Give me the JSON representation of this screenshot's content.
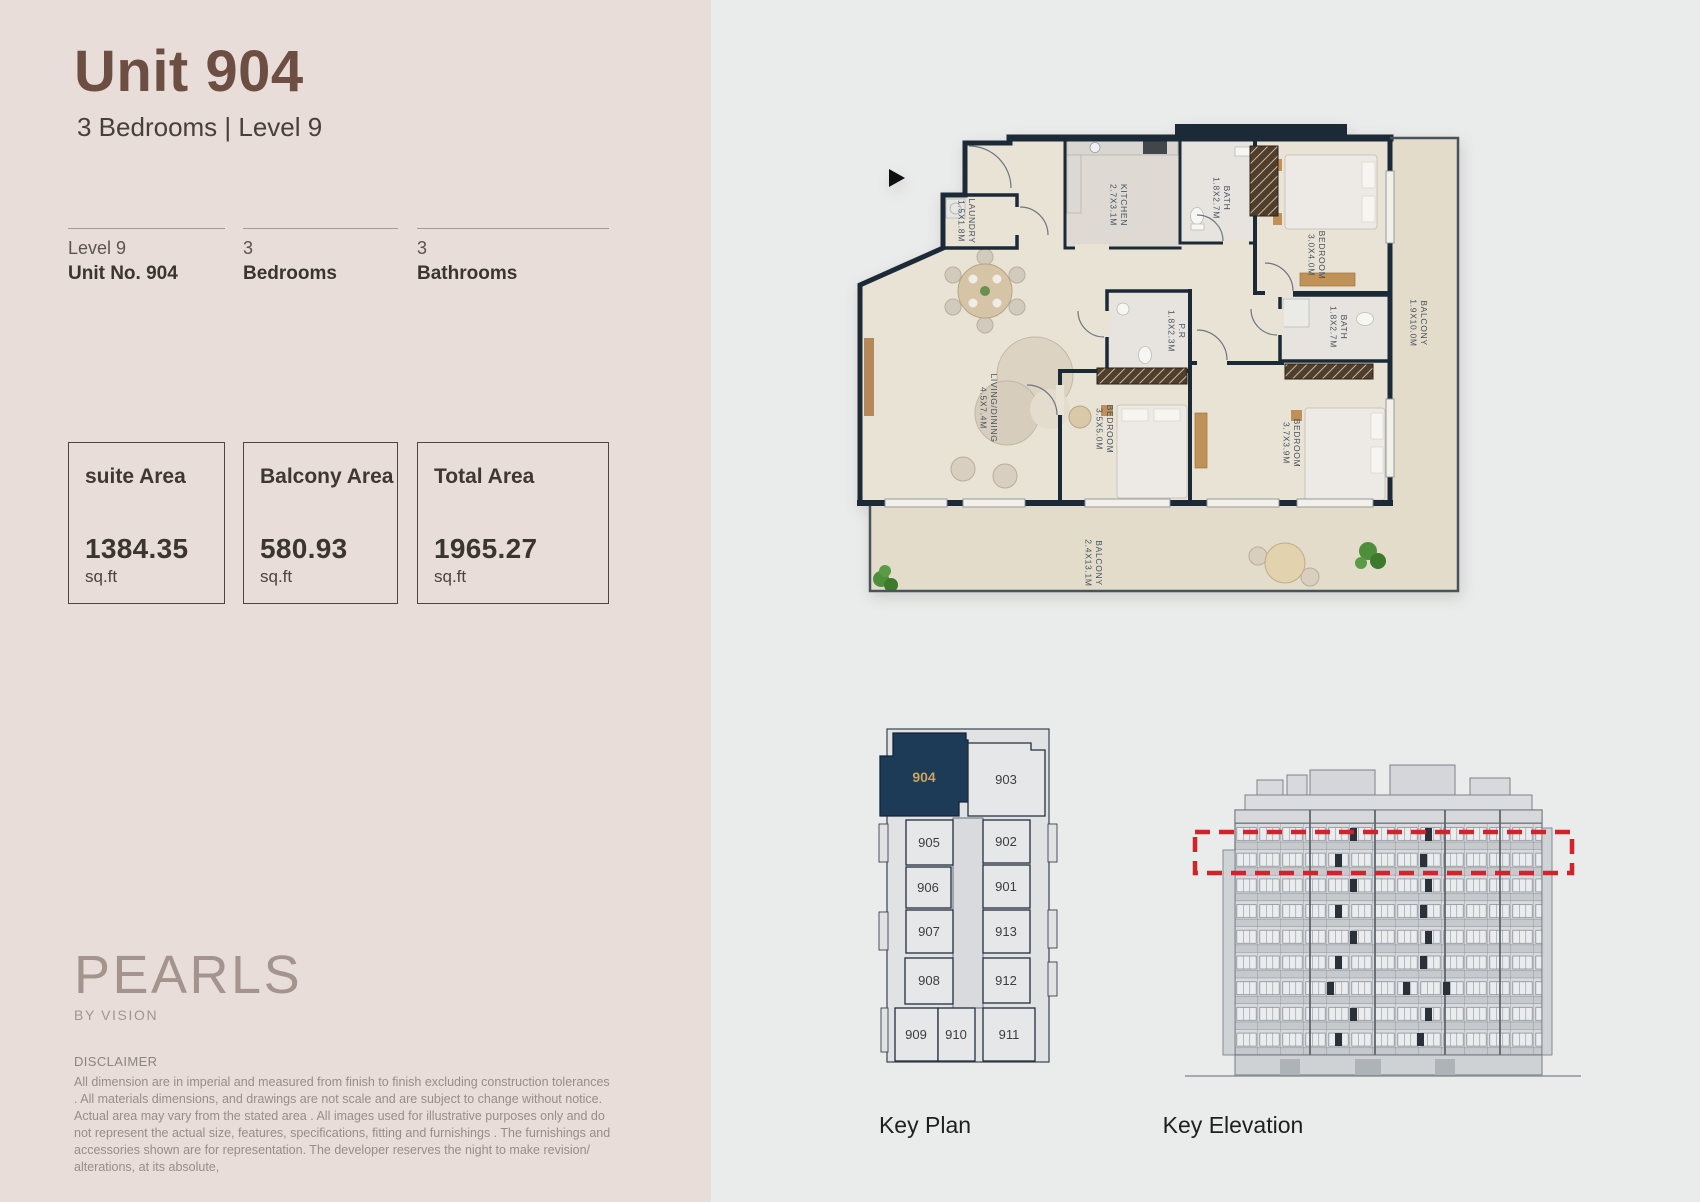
{
  "colors": {
    "left_bg": "#e8ddd9",
    "right_bg": "#eaebeb",
    "title_brown": "#6d4e43",
    "keyplan_highlight_bg": "#1d3a57",
    "keyplan_highlight_text": "#c8a557",
    "elevation_highlight_red": "#d2232a",
    "plan_wall": "#1c2a38"
  },
  "header": {
    "title": "Unit 904",
    "subtitle": "3 Bedrooms  |  Level 9"
  },
  "specs": [
    {
      "line1": "Level 9",
      "line2": "Unit No. 904"
    },
    {
      "line1": "3",
      "line2": "Bedrooms"
    },
    {
      "line1": "3",
      "line2": "Bathrooms"
    }
  ],
  "areas": [
    {
      "label": "suite  Area",
      "value": "1384.35",
      "unit": "sq.ft"
    },
    {
      "label": "Balcony Area",
      "value": "580.93",
      "unit": "sq.ft"
    },
    {
      "label": "Total Area",
      "value": "1965.27",
      "unit": "sq.ft"
    }
  ],
  "brand": {
    "logo": "PEARLS",
    "tagline": "BY VISION"
  },
  "disclaimer": {
    "heading": "DISCLAIMER",
    "body": "All dimension are in imperial and measured from finish to finish excluding construction tolerances . All materials dimensions, and drawings are not scale and are subject to change without notice. Actual area may vary from the stated area . All images used for illustrative purposes only and do not represent the actual size, features, specifications, fitting and furnishings . The furnishings and accessories shown are for representation. The developer reserves the night to make revision/ alterations, at its absolute,"
  },
  "floor_plan": {
    "rooms": [
      {
        "name": "LAUNDRY",
        "dims": "1.5X1.8M"
      },
      {
        "name": "KITCHEN",
        "dims": "2.7X3.1M"
      },
      {
        "name": "BATH",
        "dims": "1.8X2.7M"
      },
      {
        "name": "BEDROOM",
        "dims": "3.0X4.0M"
      },
      {
        "name": "BALCONY",
        "dims": "1.9X10.0M"
      },
      {
        "name": "P.R",
        "dims": "1.8X2.3M"
      },
      {
        "name": "LIVING/DINING",
        "dims": "4.5X7.4M"
      },
      {
        "name": "BEDROOM",
        "dims": "3.5X5.0M"
      },
      {
        "name": "BEDROOM",
        "dims": "3.7X3.9M"
      },
      {
        "name": "BATH",
        "dims": "1.8X2.7M"
      },
      {
        "name": "BALCONY",
        "dims": "2.4X13.1M"
      }
    ]
  },
  "key_plan": {
    "caption": "Key Plan",
    "highlighted_unit": "904",
    "units": [
      "904",
      "903",
      "905",
      "902",
      "906",
      "901",
      "907",
      "913",
      "908",
      "912",
      "909",
      "910",
      "911"
    ]
  },
  "key_elevation": {
    "caption": "Key Elevation",
    "highlighted_level": "Level 9"
  }
}
